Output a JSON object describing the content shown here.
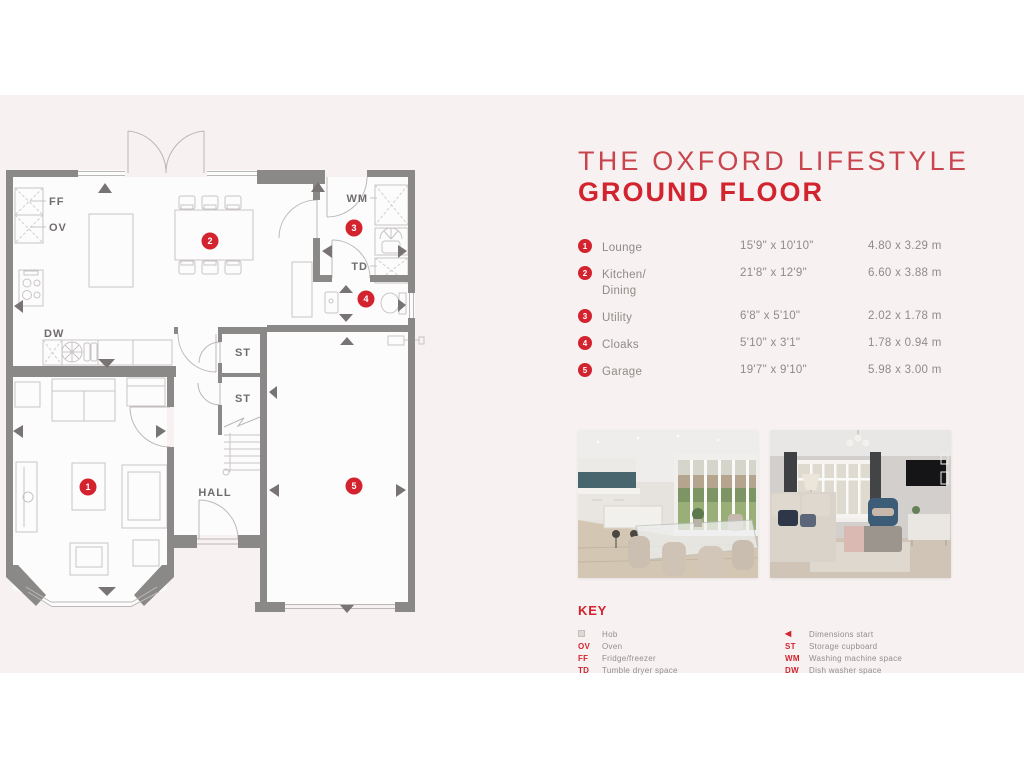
{
  "header": {
    "line1": "THE OXFORD LIFESTYLE",
    "line2": "GROUND FLOOR",
    "accent_light": "#c9454e",
    "accent": "#d2232e"
  },
  "rooms": [
    {
      "num": "1",
      "name": "Lounge",
      "imperial": "15'9\" x 10'10\"",
      "metric": "4.80 x 3.29 m"
    },
    {
      "num": "2",
      "name": "Kitchen/",
      "name2": "Dining",
      "imperial": "21'8\" x 12'9\"",
      "metric": "6.60 x 3.88 m"
    },
    {
      "num": "3",
      "name": "Utility",
      "imperial": "6'8\" x 5'10\"",
      "metric": "2.02 x 1.78 m"
    },
    {
      "num": "4",
      "name": "Cloaks",
      "imperial": "5'10\" x 3'1\"",
      "metric": "1.78 x 0.94 m"
    },
    {
      "num": "5",
      "name": "Garage",
      "imperial": "19'7\" x 9'10\"",
      "metric": "5.98 x 3.00 m"
    }
  ],
  "plan": {
    "wall_color": "#8b8888",
    "marker_color": "#d2232e",
    "markers": [
      "1",
      "2",
      "3",
      "4",
      "5"
    ],
    "labels": {
      "ff": "FF",
      "ov": "OV",
      "dw": "DW",
      "wm": "WM",
      "td": "TD",
      "st1": "ST",
      "st2": "ST",
      "hall": "HALL"
    }
  },
  "key": {
    "title": "KEY",
    "left": [
      {
        "abbr": "",
        "label": "Hob"
      },
      {
        "abbr": "OV",
        "label": "Oven"
      },
      {
        "abbr": "FF",
        "label": "Fridge/freezer"
      },
      {
        "abbr": "TD",
        "label": "Tumble dryer space"
      }
    ],
    "right": [
      {
        "abbr": "◀",
        "label": "Dimensions start"
      },
      {
        "abbr": "ST",
        "label": "Storage cupboard"
      },
      {
        "abbr": "WM",
        "label": "Washing machine space"
      },
      {
        "abbr": "DW",
        "label": "Dish washer space"
      }
    ]
  }
}
